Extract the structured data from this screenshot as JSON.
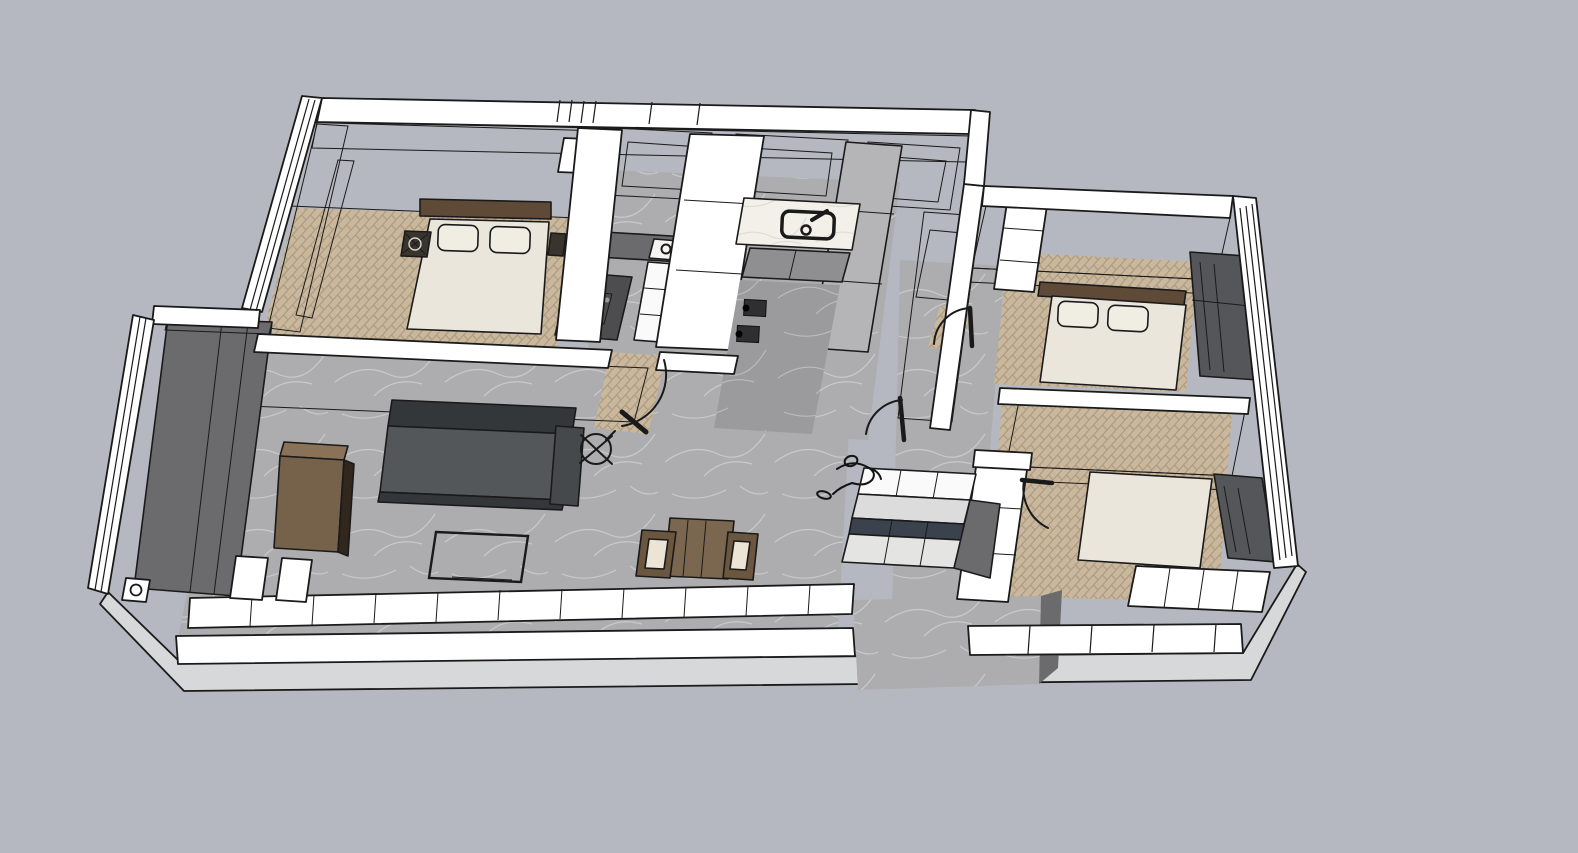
{
  "viewport": {
    "type": "3d-architectural-model-render",
    "style": "sketchup-style line render, high-angle axonometric cutaway",
    "width_px": 1578,
    "height_px": 853
  },
  "scene": {
    "subject": "Cutaway 3D floor plan of a three-bedroom apartment with furniture",
    "rooms": [
      {
        "name": "bedroom-north-west",
        "floor": "herringbone-wood",
        "contents": [
          "double-bed",
          "two-pillows",
          "dark-headboard",
          "nightstand-left",
          "nightstand-right",
          "window-wall-dark",
          "white-wardrobe-nook"
        ]
      },
      {
        "name": "kitchen",
        "floor": "marble-tile",
        "contents": [
          "upper-cabinets-gray",
          "dark-countertop",
          "cooktop-three-burners",
          "white-base-cabinet",
          "washing-machine",
          "pantry-column-white",
          "pantry-column-gray"
        ]
      },
      {
        "name": "kitchen-sink-corridor",
        "floor": "white-marble",
        "contents": [
          "white-marble-counter",
          "sink-black-outline",
          "faucet",
          "gray-peninsula-cabinet",
          "two-waste-bins"
        ]
      },
      {
        "name": "bathroom-north",
        "floor": "marble-tile",
        "contents": [
          "vanity-block-gray",
          "mirror-cabinet-gray"
        ]
      },
      {
        "name": "bedroom-north-east",
        "floor": "herringbone-wood",
        "contents": [
          "double-bed",
          "two-pillows",
          "dark-headboard",
          "wardrobe-gray",
          "white-shelf-column",
          "window-wall-dark"
        ]
      },
      {
        "name": "bedroom-south-east",
        "floor": "herringbone-wood",
        "contents": [
          "double-bed",
          "gray-wardrobe-mass",
          "white-sideboard-row",
          "white-shelf-column",
          "window-wall-dark"
        ]
      },
      {
        "name": "living-dining",
        "floor": "marble-tile",
        "contents": [
          "charcoal-sofa",
          "tv-stand-wire-outline",
          "brown-media-cabinet",
          "tall-entry-wardrobe-dark",
          "dining-table-brown",
          "dining-chair-left",
          "dining-chair-right",
          "kitchen-island-white-tiles",
          "wainscot-tile-row",
          "wall-stub-blocks",
          "door-stop-plate"
        ]
      },
      {
        "name": "hallway",
        "floor": "marble-tile",
        "contents": []
      },
      {
        "name": "entry-porch",
        "floor": "marble-tile",
        "contents": []
      }
    ],
    "symbols": [
      "ceiling-fan-cross-circle",
      "door-swing-arcs",
      "person-sketch-outline",
      "window-mullion-lines",
      "balcony-glazing-lines"
    ]
  },
  "palette": {
    "background": "#b5b8c0",
    "facade": "#d7d8da",
    "line": "#1a1a1a",
    "wall_white": "#ffffff",
    "face_light": "#b5b5b7",
    "face_mid": "#8f8f92",
    "face_dark": "#6b6b6e",
    "window_dark": "#55565a",
    "marble": "#adadaf",
    "marble_dark": "#9b9b9e",
    "marble_vein": "#d2d2d4",
    "counter_marble": "#f2f0e9",
    "counter_vein": "#d8d5cc",
    "wood_base": "#c9b89e",
    "wood_stripe": "#b09d80",
    "linen": "#eae6dc",
    "pillow": "#f0ede3",
    "headboard": "#5e4a37",
    "sofa": "#54575a",
    "sofa_dark": "#34373a",
    "cabinet_brown": "#76614b",
    "cabinet_brown_top": "#8a7258",
    "cabinet_brown_side": "#32271d",
    "table_brown": "#7b6750",
    "chair_brown": "#6b573f",
    "chair_seat": "#ece5d5",
    "island_top": "#3a424d",
    "appliance": "#4d4d50",
    "white_furniture": "#fafafa"
  }
}
